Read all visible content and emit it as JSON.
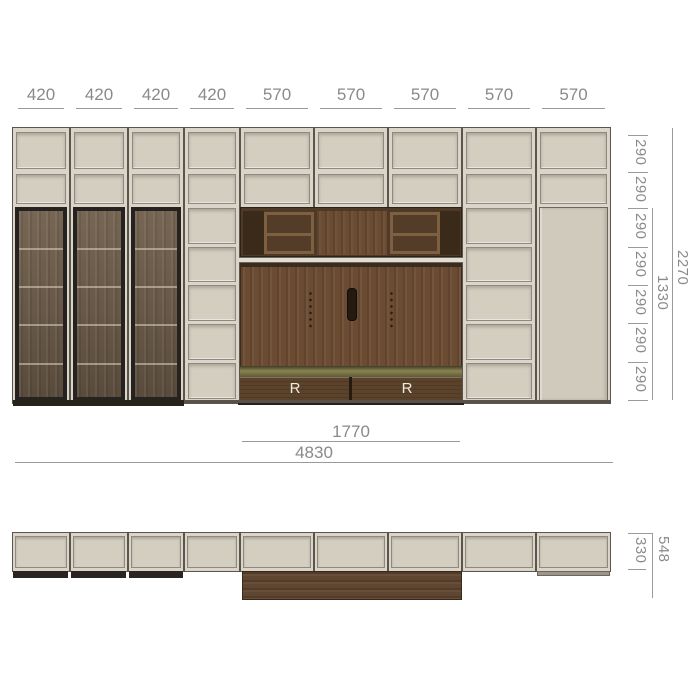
{
  "dims": {
    "top": [
      "420",
      "420",
      "420",
      "420",
      "570",
      "570",
      "570",
      "570",
      "570"
    ],
    "side": [
      "290",
      "290",
      "290",
      "290",
      "290",
      "290",
      "290"
    ],
    "height_total": "2270",
    "height_inner": "1330",
    "width_inner": "1770",
    "width_total": "4830",
    "depth_total": "548",
    "depth_body": "330"
  },
  "labels": {
    "drawer_left": "R",
    "drawer_right": "R"
  },
  "colors": {
    "beige_frame": "#dbd5c9",
    "beige_panel": "#d4cec1",
    "beige_door": "#d0cabd",
    "outline": "#5a564e",
    "walnut": "#6b4c33",
    "walnut_dark": "#4e3a26",
    "glass_frame": "#26221f",
    "glass_pane": "#6f5e4c",
    "drawer_front": "#5b422b",
    "dim_text": "#8a8a8a",
    "dim_line": "#9a9a9a"
  }
}
